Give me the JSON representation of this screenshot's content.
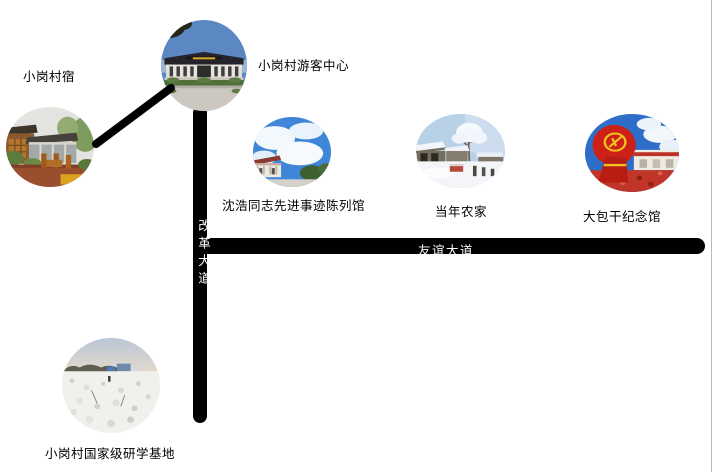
{
  "map": {
    "locations": [
      {
        "name": "guesthouse",
        "label": "小岗村宿",
        "image": "wooden-homestay-courtyard-photo"
      },
      {
        "name": "visitor-center",
        "label": "小岗村游客中心",
        "image": "visitor-center-building-photo"
      },
      {
        "name": "shenhao-exhibition",
        "label": "沈浩同志先进事迹陈列馆",
        "image": "white-hall-blue-sky-photo"
      },
      {
        "name": "dangnian-nongjia",
        "label": "当年农家",
        "image": "snowy-farmhouse-photo"
      },
      {
        "name": "dabaogan-memorial",
        "label": "大包干纪念馆",
        "image": "red-flag-monument-photo"
      },
      {
        "name": "research-base",
        "label": "小岗村国家级研学基地",
        "image": "cotton-field-photo"
      }
    ],
    "roads": [
      {
        "name": "gaige-avenue",
        "label": "改革大道",
        "orientation": "vertical"
      },
      {
        "name": "youyi-avenue",
        "label": "友谊大道",
        "orientation": "horizontal"
      }
    ],
    "colors": {
      "background": "#ffffff",
      "road": "#000000",
      "road_label": "#ffffff",
      "location_label": "#000000",
      "connector_line": "#000000",
      "right_border": "#b4b8c2"
    }
  }
}
